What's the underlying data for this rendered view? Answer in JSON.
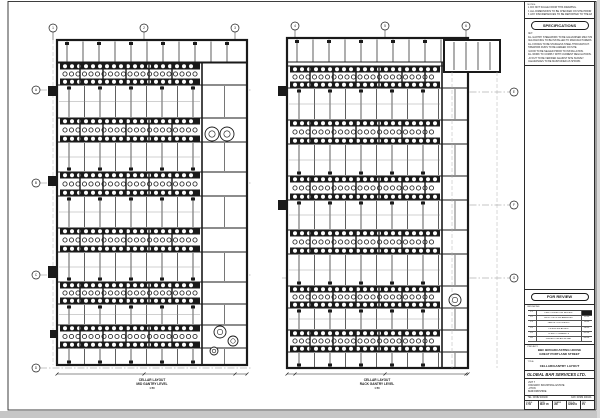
{
  "sheet": {
    "bg": "#ffffff",
    "ink": "#1a1a1a",
    "grid_gray": "#9a9a9a",
    "shadow": "#c6c6c6"
  },
  "plans": [
    {
      "name": "left-cellar-plan",
      "wall": {
        "x": 57,
        "y": 40,
        "w": 190,
        "h": 325
      },
      "topStrip": 62,
      "corridorX": 202,
      "kegBands": [
        [
          63,
          85
        ],
        [
          118,
          142
        ],
        [
          172,
          196
        ],
        [
          228,
          252
        ],
        [
          282,
          304
        ],
        [
          325,
          348
        ]
      ],
      "gridTop": {
        "cy": 28,
        "xs": [
          53,
          144,
          235
        ],
        "labels": [
          "1",
          "2",
          "3"
        ]
      },
      "sideBubbles": {
        "x": 36,
        "side": "left",
        "ys": [
          90,
          183,
          275,
          368
        ],
        "labels": [
          "A",
          "B",
          "C",
          "D"
        ]
      },
      "stubs": [
        [
          48,
          86,
          9,
          10
        ],
        [
          48,
          176,
          9,
          10
        ],
        [
          48,
          266,
          9,
          12
        ],
        [
          50,
          330,
          7,
          8
        ]
      ],
      "circles": [
        [
          212,
          134,
          7
        ],
        [
          227,
          134,
          7
        ],
        [
          220,
          332,
          6
        ],
        [
          233,
          341,
          5
        ],
        [
          214,
          351,
          4
        ]
      ],
      "dimY": 374,
      "caption": {
        "x": 152,
        "y": 381,
        "lines": [
          "CELLAR LAYOUT",
          "MID GANTRY LEVEL",
          "1:50"
        ]
      }
    },
    {
      "name": "right-cellar-plan",
      "wall": {
        "x": 287,
        "y": 38,
        "w": 181,
        "h": 330
      },
      "topStrip": 62,
      "corridorX": 442,
      "kegBands": [
        [
          66,
          88
        ],
        [
          120,
          144
        ],
        [
          176,
          200
        ],
        [
          230,
          254
        ],
        [
          286,
          308
        ],
        [
          330,
          352
        ]
      ],
      "gridTop": {
        "cy": 26,
        "xs": [
          295,
          385,
          466
        ],
        "labels": [
          "4",
          "5",
          "6"
        ]
      },
      "sideBubbles": {
        "x": 514,
        "side": "right",
        "ys": [
          92,
          205,
          278
        ],
        "labels": [
          "E",
          "F",
          "G"
        ]
      },
      "stubs": [
        [
          278,
          86,
          9,
          10
        ],
        [
          278,
          200,
          9,
          10
        ]
      ],
      "circles": [
        [
          455,
          300,
          6
        ]
      ],
      "wing": {
        "x": 444,
        "y": 40,
        "w": 56,
        "h": 32
      },
      "wingDashes": [
        452,
        497
      ],
      "dimY": 374,
      "caption": {
        "x": 377,
        "y": 381,
        "lines": [
          "CELLAR LAYOUT",
          "RACK GANTRY LEVEL",
          "1:50"
        ]
      }
    }
  ],
  "titleblock": {
    "notes": {
      "label": "NOTES:",
      "items": [
        "1. DO NOT SCALE FROM THIS DRAWING.",
        "2. ALL DIMENSIONS TO BE CHECKED ON SITE PRIOR TO ANY WORK.",
        "3. ANY DISCREPANCIES TO BE REPORTED TO THE ENGINEER."
      ]
    },
    "specifications": {
      "header": "SPECIFICATIONS",
      "lines": [
        "KEY:",
        "ALL GANTRY STEELWORK TO BE GALVANISED MILD STEEL.",
        "KEG RACKING TO BE INSTALLED TO MANUFACTURERS DETAILS.",
        "ALL FIXINGS TO BE STAINLESS STEEL THROUGHOUT.",
        "PIPEWORK RUNS TO BE AGREED ON SITE.",
        "FLOOR TO BE SEALED PRIOR TO INSTALLATION.",
        "ALL WORK TO COMPLY WITH CURRENT REGULATIONS.",
        "LAYOUT TO BE VERIFIED AGAINST SITE SURVEY.",
        "CLEARANCES TO BE MAINTAINED AS SHOWN."
      ]
    },
    "status": "FOR REVIEW",
    "revisions": {
      "label": "REVISIONS",
      "rows": [
        [
          "P1",
          "FIRST ISSUE FOR REVIEW",
          "05.05"
        ],
        [
          "P2",
          "KEG POSITIONS AMENDED",
          "12.05"
        ],
        [
          "P3",
          "GANTRY EXTENDED",
          "19.05"
        ],
        [
          "P4",
          "PIPEWORK ADDED",
          "26.05"
        ],
        [
          "P5",
          "CLIENT COMMENTS",
          "02.06"
        ],
        [
          "P6",
          "ISSUED FOR APPROVAL",
          "09.06"
        ]
      ]
    },
    "project": {
      "label": "PROJECT:",
      "lines": [
        "BBC BROADCASTING HOUSE",
        "GREAT PORTLAND STREET"
      ]
    },
    "drawing": {
      "label": "TITLE:",
      "title": "CELLAR/GANTRY LAYOUT"
    },
    "company": {
      "name": "GLOBAL BAR SERVICES LTD.",
      "address": [
        "UNIT 7",
        "KINGSWAY INDUSTRIAL ESTATE",
        "LUTON",
        "BEDFORDSHIRE"
      ],
      "tel": "TEL: 01582 400100",
      "fax": "FAX: 01582 400101"
    },
    "fields": [
      {
        "label": "SCALE",
        "value": "1:50"
      },
      {
        "label": "DATE",
        "value": "MAY 05"
      },
      {
        "label": "DRAWN",
        "value": "JW"
      },
      {
        "label": "DRG No",
        "value": "4205/01"
      },
      {
        "label": "REV",
        "value": "P1"
      }
    ]
  }
}
